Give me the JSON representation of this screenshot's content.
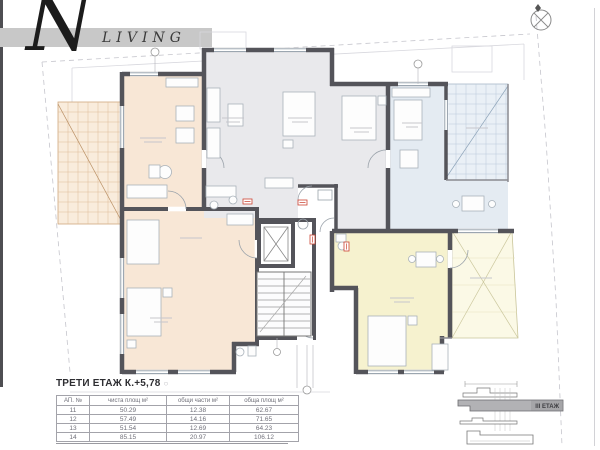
{
  "logo": {
    "letter": "N",
    "word": "LIVING"
  },
  "title": "ТРЕТИ ЕТАЖ К.+5,78",
  "table": {
    "headers": [
      "АП. №",
      "чиста площ м²",
      "общи части м²",
      "обща площ м²"
    ],
    "rows": [
      [
        "11",
        "50.29",
        "12.38",
        "62.67"
      ],
      [
        "12",
        "57.49",
        "14.16",
        "71.65"
      ],
      [
        "13",
        "51.54",
        "12.69",
        "64.23"
      ],
      [
        "14",
        "85.15",
        "20.97",
        "106.12"
      ]
    ]
  },
  "section": {
    "label": "III ЕТАЖ"
  },
  "icons": {
    "north_arrow": "crossed-circle-compass",
    "axis_marker": "circle"
  },
  "colors": {
    "apartment_peach": "#f8e7d6",
    "apartment_gray": "#e9e9ec",
    "apartment_blue": "#e4ebf2",
    "apartment_yellow": "#f6f2cf",
    "terrace_yellow": "#fbf9e6",
    "wall": "#54545a",
    "door_label_red": "#cc4433",
    "logo_bar": "#c8c8c8",
    "section_slab": "#b2b2b5"
  }
}
